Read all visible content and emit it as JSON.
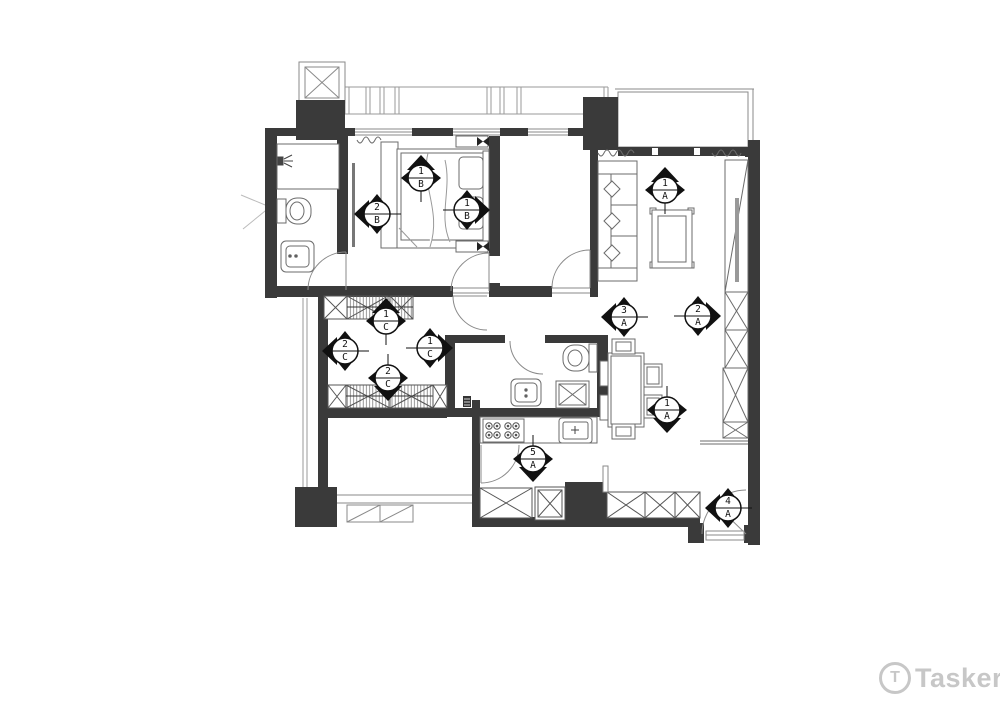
{
  "watermark": {
    "logo_letter": "T",
    "brand": "Tasker"
  },
  "markers": [
    {
      "num": "1",
      "letter": "B",
      "direction": "up"
    },
    {
      "num": "2",
      "letter": "B",
      "direction": "left"
    },
    {
      "num": "1",
      "letter": "B",
      "direction": "right"
    },
    {
      "num": "1",
      "letter": "C",
      "direction": "up"
    },
    {
      "num": "2",
      "letter": "C",
      "direction": "left"
    },
    {
      "num": "1",
      "letter": "C",
      "direction": "right"
    },
    {
      "num": "2",
      "letter": "C",
      "direction": "down"
    },
    {
      "num": "1",
      "letter": "A",
      "direction": "up"
    },
    {
      "num": "3",
      "letter": "A",
      "direction": "left"
    },
    {
      "num": "2",
      "letter": "A",
      "direction": "right"
    },
    {
      "num": "1",
      "letter": "A",
      "direction": "down"
    },
    {
      "num": "5",
      "letter": "A",
      "direction": "down"
    },
    {
      "num": "4",
      "letter": "A",
      "direction": "left"
    }
  ],
  "colors": {
    "wall": "#3a3a3a",
    "furniture_line": "#6b6b6b",
    "light_line": "#9a9a9a",
    "watermark": "#c7c7c7"
  },
  "icons": {
    "shower": "shower-icon",
    "toilet": "toilet-icon",
    "sink": "sink-icon",
    "bed": "bed-icon",
    "wardrobe": "wardrobe-hanging-icon",
    "sofa": "sofa-icon",
    "coffee_table": "coffee-table-icon",
    "tv_cabinet": "tv-cabinet-icon",
    "dining_table": "dining-table-icon",
    "stove": "stove-icon",
    "washer": "washing-machine-icon",
    "door_swing": "door-swing-icon",
    "window": "window-icon",
    "floor_drain": "floor-drain-icon",
    "elevator_shaft": "shaft-x-box-icon"
  }
}
